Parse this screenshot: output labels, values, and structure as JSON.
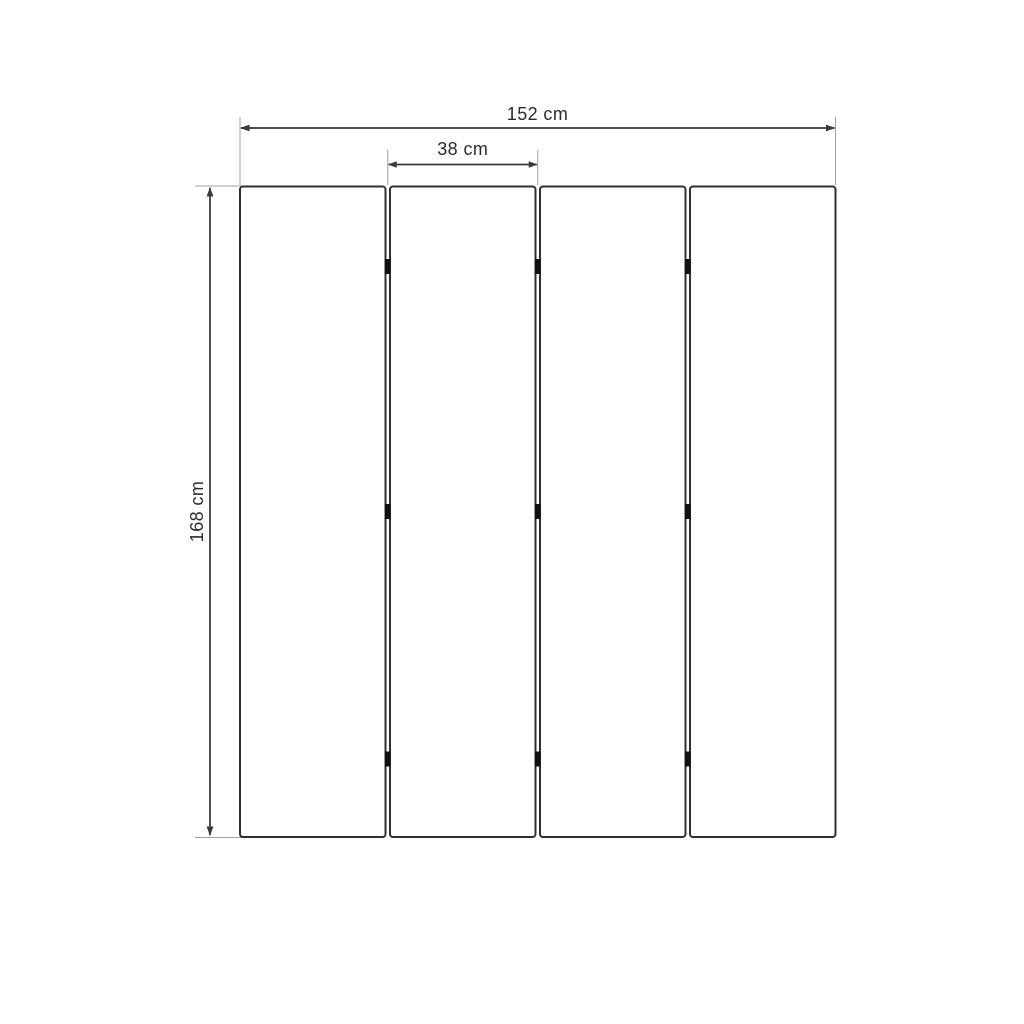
{
  "diagram": {
    "kind": "panel-dimension-drawing",
    "panel_count": 4,
    "joint_count": 3,
    "hinges_per_joint": 3,
    "dimensions": {
      "total_width": {
        "label": "152 cm",
        "value_cm": 152
      },
      "panel_width": {
        "label": "38 cm",
        "value_cm": 38
      },
      "height": {
        "label": "168 cm",
        "value_cm": 168
      }
    },
    "colors": {
      "background": "#ffffff",
      "panel_fill": "#ffffff",
      "panel_outline": "#2f2f2f",
      "dimension_line": "#3a3a3a",
      "extension_line": "#a0a0a0",
      "hinge": "#111111",
      "label_text": "#2b2b2b"
    }
  }
}
